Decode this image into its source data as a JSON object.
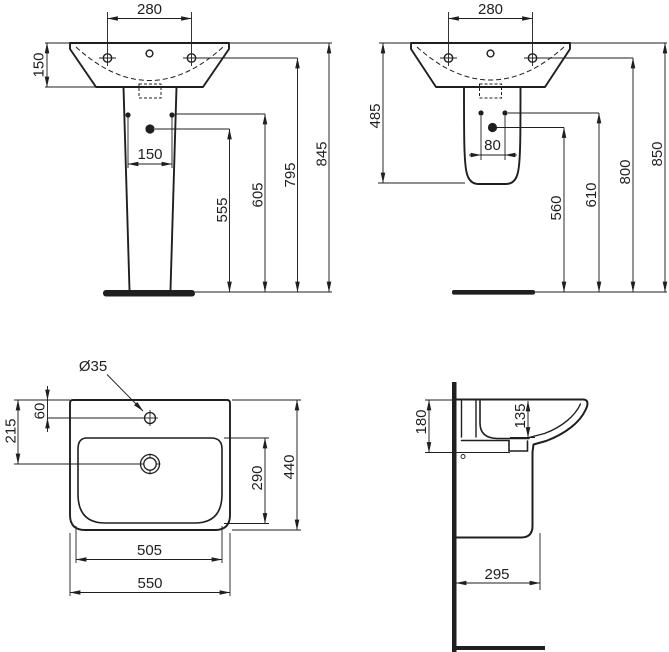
{
  "colors": {
    "ink": "#1f1f1f",
    "background": "#ffffff"
  },
  "views": {
    "front_pedestal": {
      "dims": {
        "tap_centres": "280",
        "rim_to_basin_bottom": "150",
        "fixing_centres": "150",
        "outlet_height": "555",
        "fixing_height": "605",
        "tap_height": "795",
        "overall_height": "845"
      }
    },
    "front_semi_pedestal": {
      "dims": {
        "tap_centres": "280",
        "rim_to_semi_pedestal_bottom": "485",
        "fixing_centres": "80",
        "outlet_height": "560",
        "fixing_height": "610",
        "tap_height": "800",
        "overall_height": "850"
      }
    },
    "plan": {
      "dims": {
        "tap_hole_diameter": "Ø35",
        "rim_to_tap_centre": "60",
        "rim_to_outlet_centre": "215",
        "bowl_depth": "290",
        "overall_depth": "440",
        "bowl_width": "505",
        "overall_width": "550"
      }
    },
    "side": {
      "dims": {
        "rim_to_underside": "180",
        "front_apron_depth": "135",
        "wall_projection": "295"
      }
    }
  }
}
